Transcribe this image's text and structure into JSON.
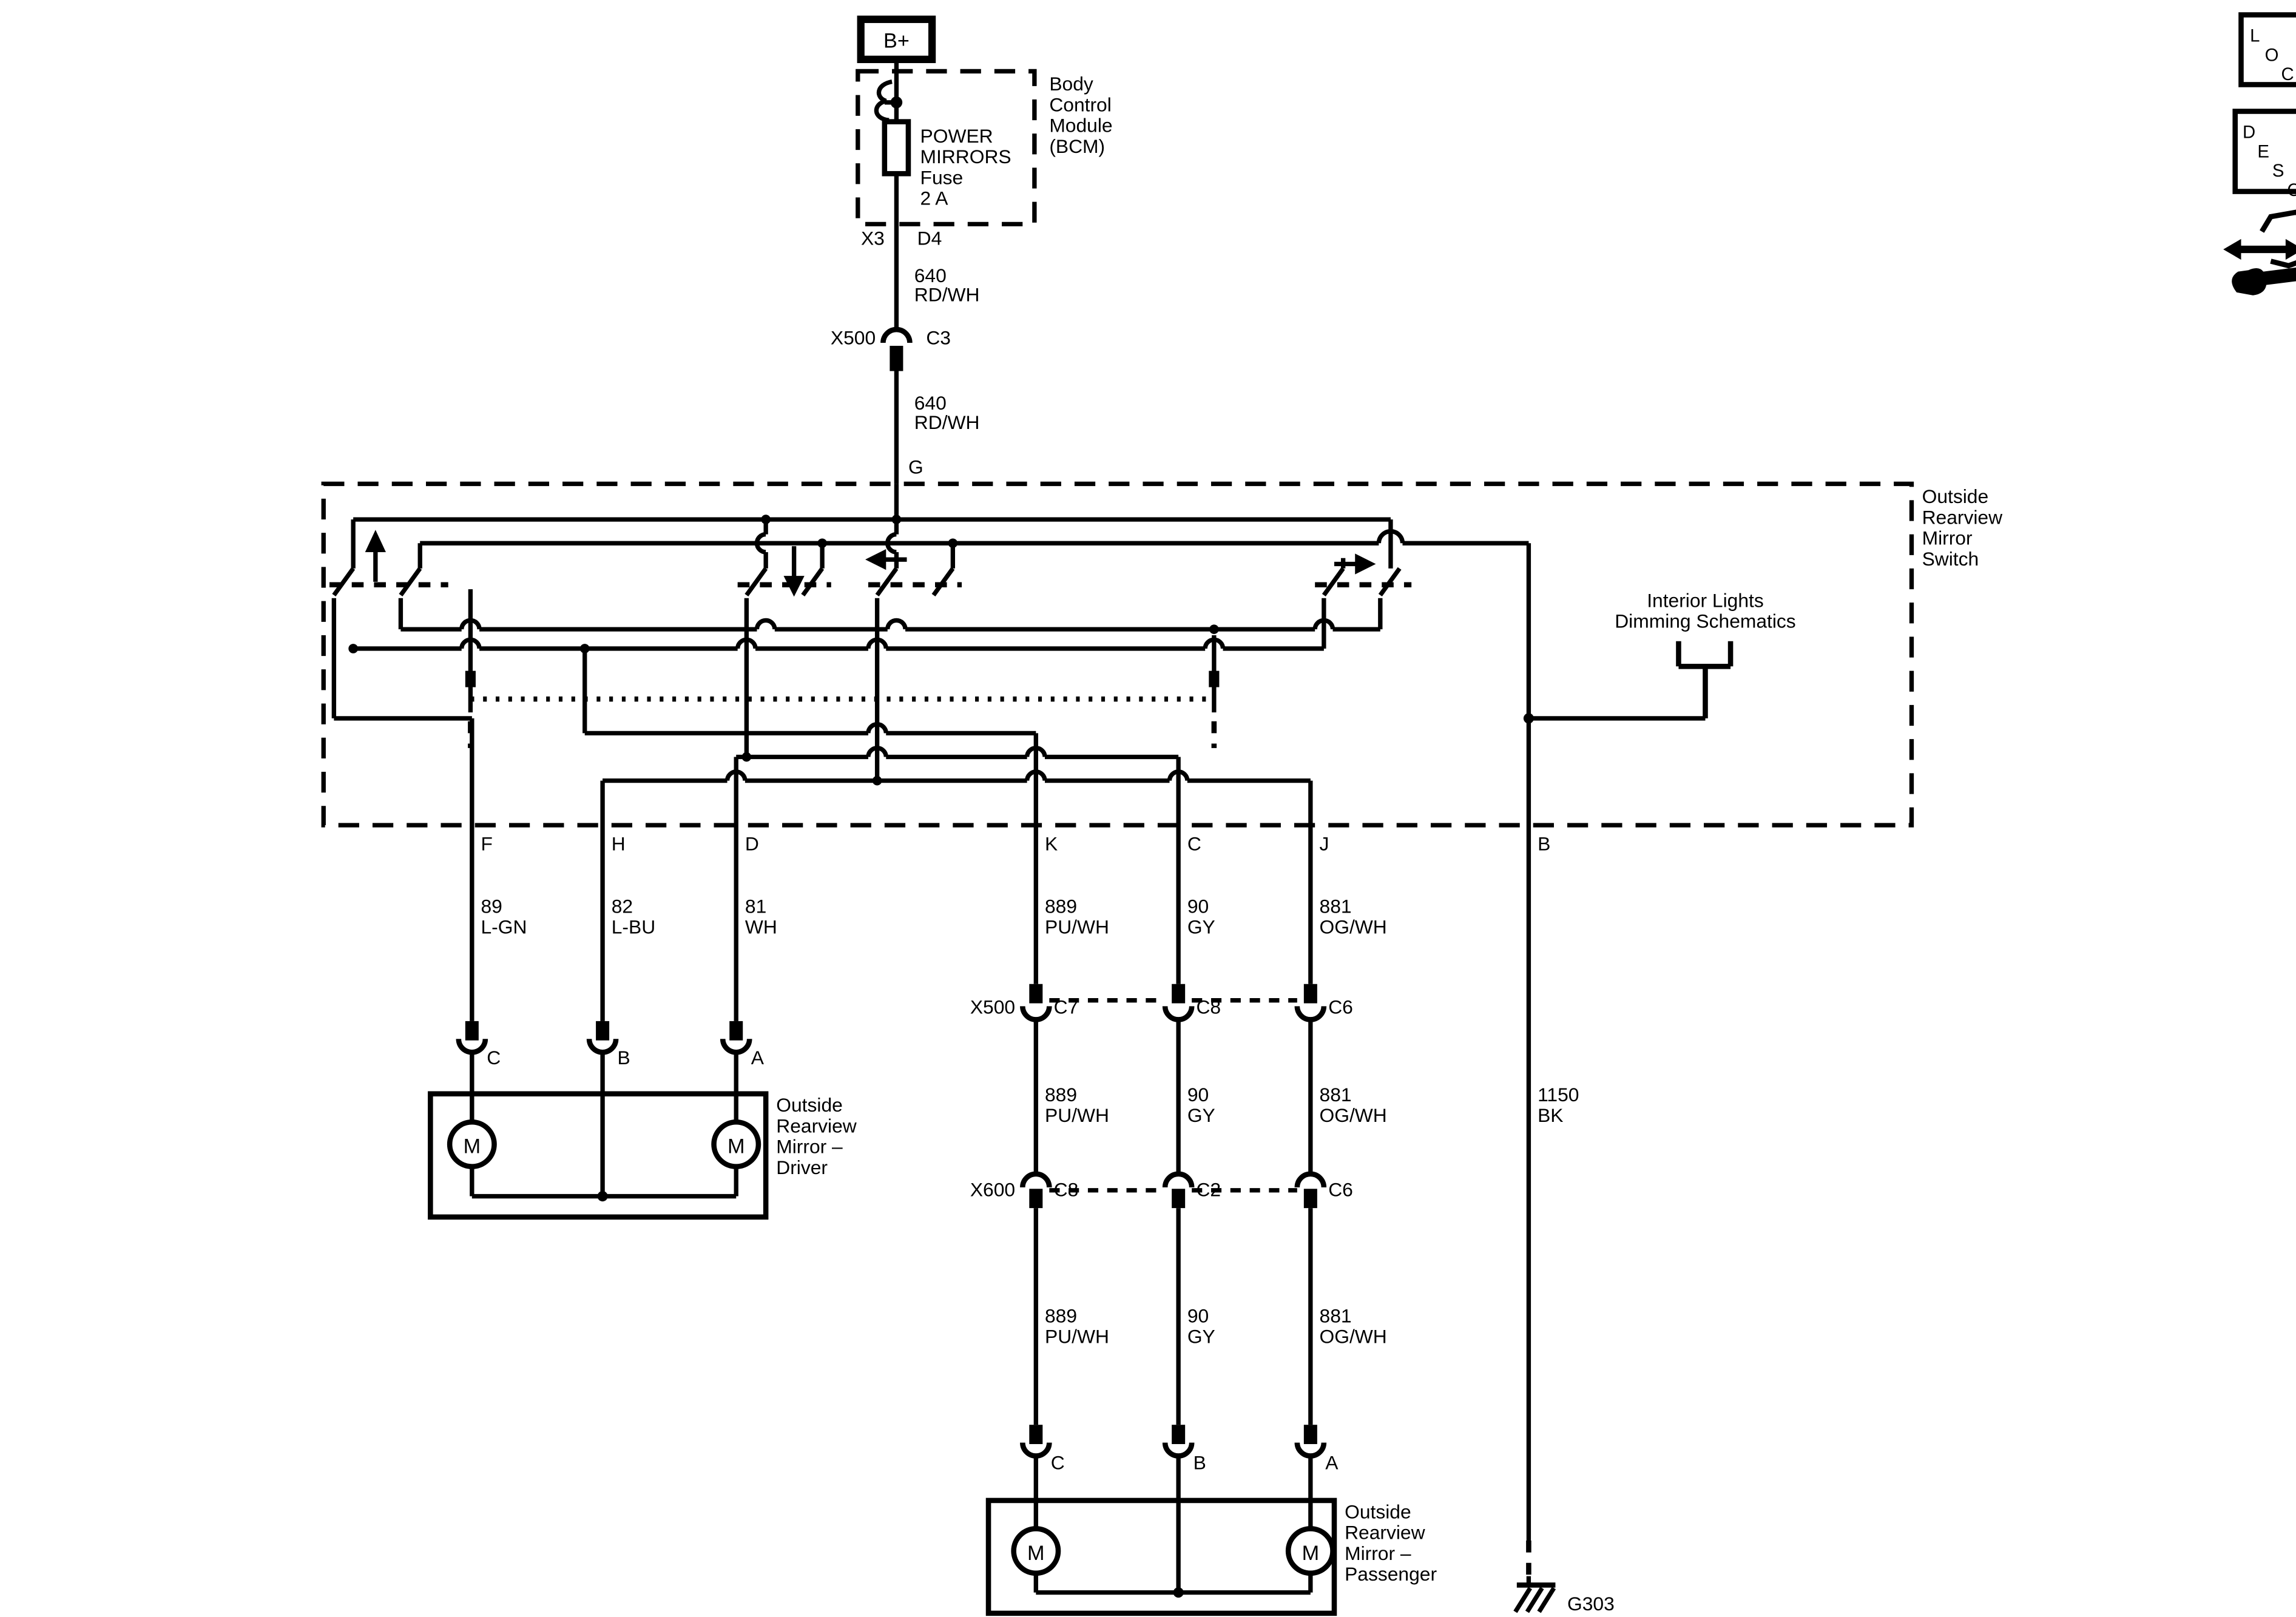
{
  "accent_color": "#000000",
  "background_color": "#ffffff",
  "power": {
    "battery_label": "B+"
  },
  "bcm": {
    "module_lines": [
      "Body",
      "Control",
      "Module",
      "(BCM)"
    ],
    "fuse_lines": [
      "POWER",
      "MIRRORS",
      "Fuse",
      "2 A"
    ],
    "pin_left": "X3",
    "pin_right": "D4"
  },
  "feed": {
    "wire_upper": [
      "640",
      "RD/WH"
    ],
    "conn_name": "X500",
    "conn_pin": "C3",
    "wire_lower": [
      "640",
      "RD/WH"
    ],
    "switch_pin": "G"
  },
  "switch_box": {
    "label_lines": [
      "Outside",
      "Rearview",
      "Mirror",
      "Switch"
    ],
    "interior_ref_lines": [
      "Interior Lights",
      "Dimming Schematics"
    ],
    "pins": {
      "f": "F",
      "h": "H",
      "d": "D",
      "k": "K",
      "c": "C",
      "j": "J",
      "b": "B"
    }
  },
  "wire_labels": {
    "f": [
      "89",
      "L-GN"
    ],
    "h": [
      "82",
      "L-BU"
    ],
    "d": [
      "81",
      "WH"
    ],
    "k": [
      "889",
      "PU/WH"
    ],
    "c": [
      "90",
      "GY"
    ],
    "j": [
      "881",
      "OG/WH"
    ],
    "b": [
      "1150",
      "BK"
    ]
  },
  "x500_row": {
    "name": "X500",
    "pins": [
      "C7",
      "C8",
      "C6"
    ]
  },
  "x600_row": {
    "name": "X600",
    "pins": [
      "C8",
      "C2",
      "C6"
    ]
  },
  "mirror_driver": {
    "label_lines": [
      "Outside",
      "Rearview",
      "Mirror –",
      "Driver"
    ],
    "pins": [
      "C",
      "B",
      "A"
    ],
    "motor": "M"
  },
  "mirror_passenger": {
    "label_lines": [
      "Outside",
      "Rearview",
      "Mirror –",
      "Passenger"
    ],
    "pins": [
      "C",
      "B",
      "A"
    ],
    "motor": "M"
  },
  "ground": {
    "label": "G303"
  },
  "corner_icons": {
    "loc_letters": [
      "L",
      "O",
      "C"
    ],
    "desc_letters": [
      "D",
      "E",
      "S",
      "C"
    ]
  }
}
